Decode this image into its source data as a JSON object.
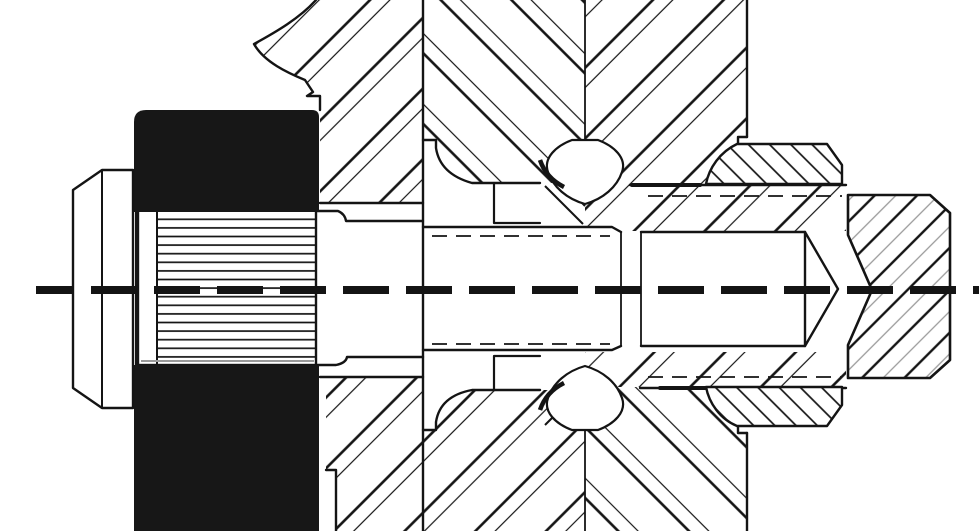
{
  "canvas": {
    "width": 979,
    "height": 531,
    "background_color": "#ffffff",
    "line_color": "#141414",
    "gray_line_color": "#9a9a9a",
    "solid_fill_color": "#171717"
  },
  "drawing": {
    "type": "mechanical-section-view",
    "parts": [
      {
        "id": "centerline",
        "name": "dashed-centerline"
      },
      {
        "id": "hex-bolt",
        "name": "hex-bolt-head-left"
      },
      {
        "id": "washer",
        "name": "washer-face"
      },
      {
        "id": "flange-hub-upper",
        "name": "solid-flange-hub-upper"
      },
      {
        "id": "flange-hub-lower",
        "name": "solid-flange-hub-lower"
      },
      {
        "id": "spline-joint",
        "name": "splined-hub-shaft-joint"
      },
      {
        "id": "gear-web-upper",
        "name": "gear-web-section-upper-left"
      },
      {
        "id": "gear-web-lower",
        "name": "gear-web-section-lower-left"
      },
      {
        "id": "gear-rim-upper",
        "name": "herringbone-gear-rim-upper"
      },
      {
        "id": "gear-rim-lower",
        "name": "herringbone-gear-rim-lower"
      },
      {
        "id": "hub-sleeve-upper",
        "name": "hatched-hub-sleeve-upper"
      },
      {
        "id": "hub-sleeve-lower",
        "name": "hatched-hub-sleeve-lower"
      },
      {
        "id": "detent-upper",
        "name": "detent-ball-profile-upper"
      },
      {
        "id": "detent-lower",
        "name": "detent-ball-profile-lower"
      },
      {
        "id": "spacer-upper",
        "name": "spacer-step-upper"
      },
      {
        "id": "spacer-lower",
        "name": "spacer-step-lower"
      },
      {
        "id": "shaft-journal",
        "name": "shaft-journal-section"
      },
      {
        "id": "shaft-thread",
        "name": "threaded-shaft-end-pointed"
      },
      {
        "id": "locknut-upper",
        "name": "sectioned-locknut-upper"
      },
      {
        "id": "locknut-lower",
        "name": "sectioned-locknut-lower"
      },
      {
        "id": "end-block",
        "name": "chamfered-coupling-block-right"
      }
    ]
  }
}
